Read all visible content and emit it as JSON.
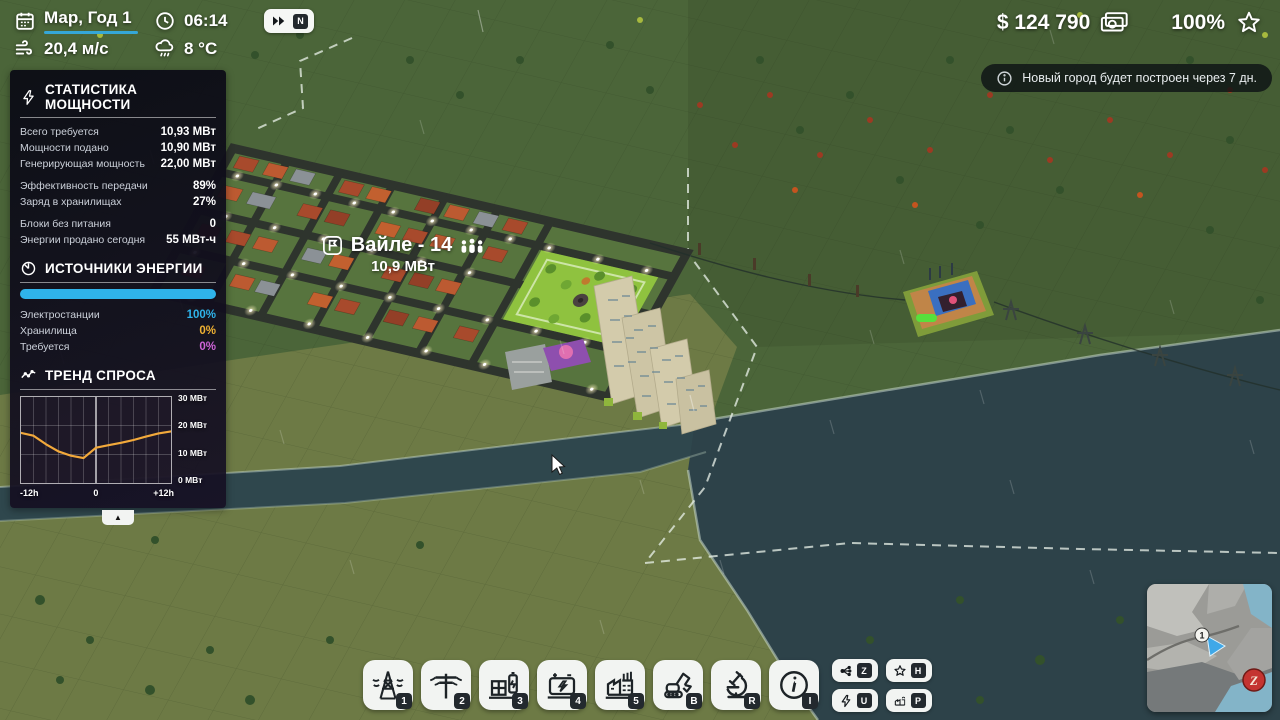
{
  "hud": {
    "date": "Мар, Год 1",
    "time": "06:14",
    "speed_badge": "N",
    "wind_speed": "20,4 м/с",
    "temperature": "8 °C",
    "money": "$ 124 790",
    "approval": "100%"
  },
  "notification": {
    "text": "Новый город будет построен через 7 дн."
  },
  "power_panel": {
    "title": "СТАТИСТИКА МОЩНОСТИ",
    "stats": [
      {
        "label": "Всего требуется",
        "value": "10,93 МВт"
      },
      {
        "label": "Мощности подано",
        "value": "10,90 МВт"
      },
      {
        "label": "Генерирующая мощность",
        "value": "22,00 МВт"
      },
      {
        "label": "Эффективность передачи",
        "value": "89%"
      },
      {
        "label": "Заряд в хранилищах",
        "value": "27%"
      },
      {
        "label": "Блоки без питания",
        "value": "0"
      },
      {
        "label": "Энергии продано сегодня",
        "value": "55 МВт-ч"
      }
    ],
    "sources": {
      "title": "ИСТОЧНИКИ ЭНЕРГИИ",
      "bar_color": "#2fb3ea",
      "rows": [
        {
          "label": "Электростанции",
          "value": "100%",
          "color": "#2fb3ea"
        },
        {
          "label": "Хранилища",
          "value": "0%",
          "color": "#f0b232"
        },
        {
          "label": "Требуется",
          "value": "0%",
          "color": "#cf64d8"
        }
      ]
    },
    "trend_title": "ТРЕНД СПРОСА",
    "collapse_arrow": "▲"
  },
  "chart_data": {
    "type": "line",
    "title": "ТРЕНД СПРОСА",
    "xlabel": "hours relative to now",
    "ylabel": "МВт",
    "x_hours": [
      -12,
      -10,
      -8,
      -6,
      -4,
      -2,
      0,
      2,
      4,
      6,
      8,
      10,
      12
    ],
    "values_mw": [
      17.5,
      16.5,
      13.5,
      11,
      9.5,
      8.7,
      12.3,
      13.2,
      14,
      15,
      16.2,
      17.3,
      18
    ],
    "ylim": [
      0,
      30
    ],
    "yticks": [
      "30 МВт",
      "20 МВт",
      "10 МВт",
      "0 МВт"
    ],
    "xticks": [
      "-12h",
      "0",
      "+12h"
    ],
    "line_color": "#f2a93b",
    "grid": true,
    "legend": "none",
    "now_marker": "vertical line at 0"
  },
  "city_label": {
    "name": "Вайле - 14",
    "power": "10,9 МВт"
  },
  "toolbar": {
    "items": [
      {
        "name": "transmission-tower",
        "badge": "1"
      },
      {
        "name": "power-pole",
        "badge": "2"
      },
      {
        "name": "substation",
        "badge": "3"
      },
      {
        "name": "battery-storage",
        "badge": "4"
      },
      {
        "name": "power-plant",
        "badge": "5"
      },
      {
        "name": "demolish",
        "badge": "B"
      },
      {
        "name": "research",
        "badge": "R"
      },
      {
        "name": "info",
        "badge": "I"
      }
    ]
  },
  "hotkeys": {
    "items": [
      {
        "name": "grid-overlay",
        "key": "Z"
      },
      {
        "name": "approval-overlay",
        "key": "H"
      },
      {
        "name": "power-overlay",
        "key": "U"
      },
      {
        "name": "production-overlay",
        "key": "P"
      }
    ]
  },
  "minimap": {
    "marker": "1",
    "logo_letter": "Z"
  },
  "colors": {
    "accent_blue": "#35a7d8",
    "panel_bg": "#0d0f1a",
    "water": "#2d4249"
  }
}
